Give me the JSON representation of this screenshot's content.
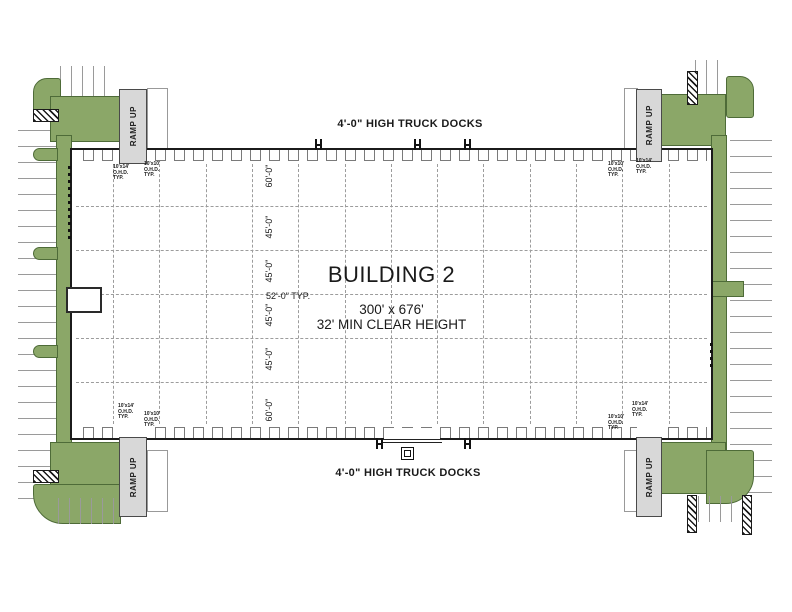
{
  "drawing": {
    "building_name": "BUILDING 2",
    "building_size": "300' x 676'",
    "clear_height": "32' MIN CLEAR HEIGHT",
    "truck_docks_top": "4'-0\" HIGH TRUCK DOCKS",
    "truck_docks_bottom": "4'-0\" HIGH TRUCK DOCKS",
    "bay_spacing": "52'-0\" TYP.",
    "ramp_label": "RAMP UP",
    "row_dimensions": [
      "60'-0\"",
      "45'-0\"",
      "45'-0\"",
      "45'-0\"",
      "45'-0\"",
      "60'-0\""
    ],
    "drive_in_door": {
      "line1": "10'x14'",
      "line2": "O.H.D.",
      "line3": "TYP."
    },
    "dock_door": {
      "line1": "10'x10'",
      "line2": "O.H.D.",
      "line3": "TYP."
    }
  },
  "colors": {
    "landscape": "#8BA768",
    "landscape_edge": "#4E6B38",
    "ramp_fill": "#D8D8D8",
    "building_outline": "#1B1B1B",
    "grid_line": "#9C9C9C"
  }
}
